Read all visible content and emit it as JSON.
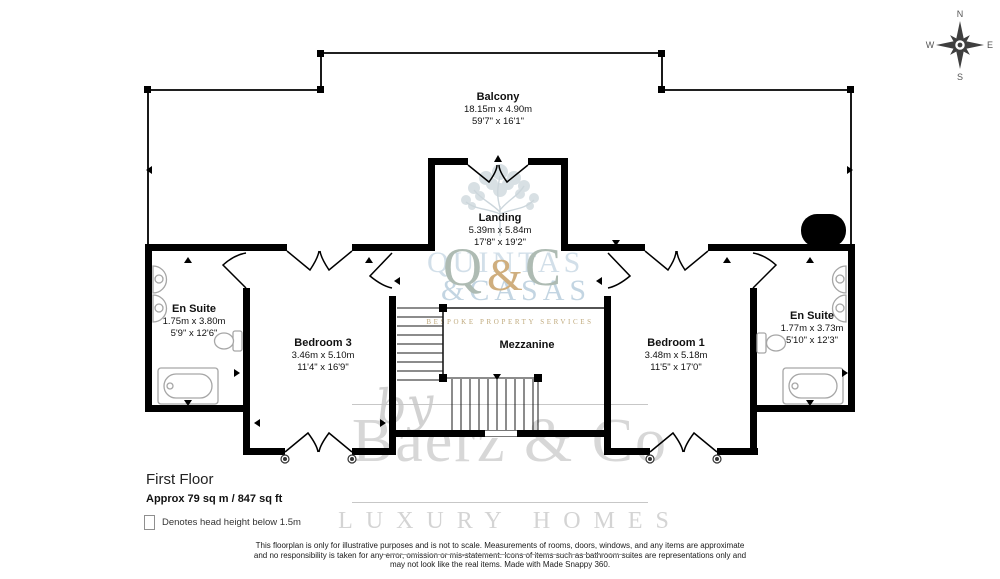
{
  "compass": {
    "n": "N",
    "e": "E",
    "s": "S",
    "w": "W"
  },
  "rooms": {
    "balcony": {
      "name": "Balcony",
      "metric": "18.15m x 4.90m",
      "imperial": "59'7\" x 16'1\""
    },
    "landing": {
      "name": "Landing",
      "metric": "5.39m x 5.84m",
      "imperial": "17'8\" x 19'2\""
    },
    "ensuite_left": {
      "name": "En Suite",
      "metric": "1.75m x 3.80m",
      "imperial": "5'9\" x 12'6\""
    },
    "bedroom3": {
      "name": "Bedroom 3",
      "metric": "3.46m x 5.10m",
      "imperial": "11'4\" x 16'9\""
    },
    "mezzanine": {
      "name": "Mezzanine",
      "metric": "",
      "imperial": ""
    },
    "bedroom1": {
      "name": "Bedroom 1",
      "metric": "3.48m x 5.18m",
      "imperial": "11'5\" x 17'0\""
    },
    "ensuite_right": {
      "name": "En Suite",
      "metric": "1.77m x 3.73m",
      "imperial": "5'10\" x 12'3\""
    }
  },
  "floor_info": {
    "title": "First Floor",
    "area": "Approx 79 sq m / 847 sq ft"
  },
  "legend": {
    "label": "Denotes head height below 1.5m"
  },
  "disclaimer": {
    "line1": "This floorplan is only for illustrative purposes and is not to scale. Measurements of rooms, doors, windows, and any items are approximate",
    "line2": "and no responsibility is taken for any error, omission or mis-statement. Icons of items such as bathroom suites are representations only and",
    "line3": "may not look like the real items. Made with Made Snappy 360."
  },
  "watermarks": {
    "agency_by": "by",
    "agency_name": "Baerz & Co",
    "agency_tagline": "LUXURY HOMES",
    "logo_q": "Q",
    "logo_amp": "&",
    "logo_c": "C",
    "logo_line1": "QUINTAS",
    "logo_line2": "&CASAS",
    "logo_subtitle": "BESPOKE PROPERTY SERVICES"
  },
  "colors": {
    "wall": "#000000",
    "watermark_gray": "#d8d8d8",
    "logo_gold": "#cfae7e",
    "logo_teal": "#aebbb3",
    "logo_blue": "#c5d6e2"
  }
}
